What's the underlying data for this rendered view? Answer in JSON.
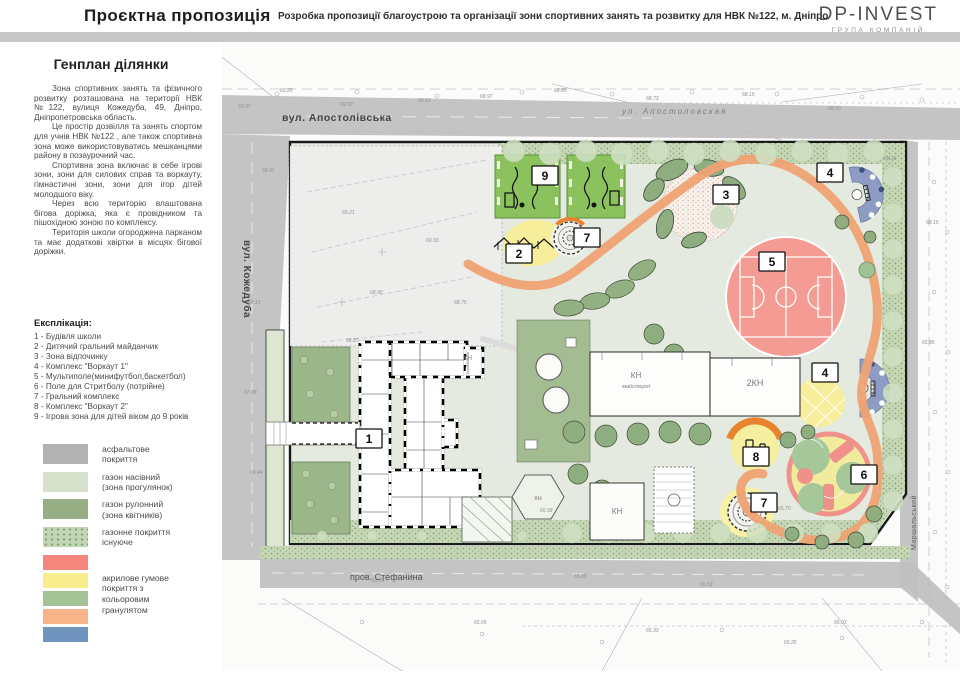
{
  "header": {
    "title": "Проєктна пропозиція",
    "subtitle": "Розробка пропозиції благоустрою та організації зони спортивних занять та розвитку для НВК №122, м. Дніпро",
    "logo": {
      "name": "DP-INVEST",
      "tagline": "ГРУПА КОМПАНІЙ"
    }
  },
  "sidebar": {
    "heading": "Генплан ділянки",
    "paragraphs": [
      "Зона спортивних занять та фізичного розвитку розташована на території НВК №122, вулиця Кожедуба, 49, Дніпро, Дніпропетровська область.",
      "Це простір дозвілля та занять спортом для учнів НВК №122 , але також спортивна зона може використовуватись мешканцями району в позаурочний час.",
      "Спортивна зона включає в себе ігрові зони, зони для силових справ та воркауту, гімнастичні зони, зони для ігор дітей молодшого віку.",
      "Через всю територію влаштована бігова доріжка, яка є провідником та пішохідною зоною по комплексу.",
      "Територія школи огороджена парканом та має додаткові хвіртки в місцях бігової доріжки."
    ],
    "explication_heading": "Експлікація:",
    "explication": [
      "1 - Будівля школи",
      "2 - Дитячий гральний майданчик",
      "3 - Зона відпочинку",
      "4 - Комплекс \"Воркаут 1\"",
      "5 - Мультиполе(минифутбол,баскетбол)",
      "6 - Поле для Стритболу (потрійне)",
      "7 - Гральний комплекс",
      "8 - Комплекс \"Воркаут 2\"",
      "9 - Ігрова зона для дітей віком до 9 років"
    ]
  },
  "surface_legend": {
    "simple": [
      {
        "color": "#b2b2b2",
        "type": "solid",
        "label": "асфальтове\nпокриття"
      },
      {
        "color": "#d6e0cb",
        "type": "solid",
        "label": "газон насівний\n(зона прогулянок)"
      },
      {
        "color": "#97ad83",
        "type": "solid",
        "label": "газон рулонний\n(зона квітників)"
      },
      {
        "color": "#c3d6b3",
        "type": "dotted",
        "label": "газонне покриття\nіснуюче"
      }
    ],
    "granulate": {
      "colors": [
        "#f5877f",
        "#f9ee8e",
        "#a3c296",
        "#f6b488",
        "#6f94bd"
      ],
      "label": "акрилове гумове\nпокриття з\nкольоровим\nгранулятом"
    }
  },
  "map": {
    "street_labels": {
      "apostolivska": "вул. Апостолівська",
      "apostolovskaya_survey": "ул. Апостоловская",
      "kozheduba": "вул. Кожедуба",
      "stefanyna": "пров. Стефанина",
      "marshalskyi": "Маршальський"
    },
    "building_labels": [
      {
        "x": 246,
        "y": 318,
        "t": "КН",
        "s": 6
      },
      {
        "x": 414,
        "y": 336,
        "t": "КН",
        "s": 8
      },
      {
        "x": 414,
        "y": 346,
        "t": "майстерні",
        "s": 5.5
      },
      {
        "x": 533,
        "y": 344,
        "t": "2КН",
        "s": 9
      },
      {
        "x": 395,
        "y": 472,
        "t": "КН",
        "s": 8
      },
      {
        "x": 316,
        "y": 458,
        "t": "КН",
        "s": 5.5
      }
    ],
    "markers": [
      {
        "n": "1",
        "x": 147,
        "y": 397
      },
      {
        "n": "2",
        "x": 297,
        "y": 212
      },
      {
        "n": "3",
        "x": 504,
        "y": 153
      },
      {
        "n": "4",
        "x": 608,
        "y": 131
      },
      {
        "n": "4",
        "x": 603,
        "y": 331
      },
      {
        "n": "5",
        "x": 550,
        "y": 220
      },
      {
        "n": "6",
        "x": 642,
        "y": 433
      },
      {
        "n": "7",
        "x": 365,
        "y": 196
      },
      {
        "n": "7",
        "x": 542,
        "y": 461
      },
      {
        "n": "8",
        "x": 534,
        "y": 415
      },
      {
        "n": "9",
        "x": 323,
        "y": 134
      }
    ],
    "survey_marks": [
      {
        "x": 58,
        "y": 50,
        "v": "69.25"
      },
      {
        "x": 16,
        "y": 66,
        "v": "69.07"
      },
      {
        "x": 118,
        "y": 64,
        "v": "69.50"
      },
      {
        "x": 196,
        "y": 60,
        "v": "69.53"
      },
      {
        "x": 258,
        "y": 56,
        "v": "68.97"
      },
      {
        "x": 332,
        "y": 50,
        "v": "68.85"
      },
      {
        "x": 424,
        "y": 58,
        "v": "68.73"
      },
      {
        "x": 520,
        "y": 54,
        "v": "68.15"
      },
      {
        "x": 606,
        "y": 68,
        "v": "68.20"
      },
      {
        "x": 40,
        "y": 130,
        "v": "68.91"
      },
      {
        "x": 26,
        "y": 262,
        "v": "68.15"
      },
      {
        "x": 22,
        "y": 352,
        "v": "67.88"
      },
      {
        "x": 28,
        "y": 432,
        "v": "66.44"
      },
      {
        "x": 120,
        "y": 172,
        "v": "69.21"
      },
      {
        "x": 204,
        "y": 200,
        "v": "69.33"
      },
      {
        "x": 148,
        "y": 252,
        "v": "68.90"
      },
      {
        "x": 232,
        "y": 262,
        "v": "68.75"
      },
      {
        "x": 124,
        "y": 300,
        "v": "68.87"
      },
      {
        "x": 150,
        "y": 540,
        "v": "65.64"
      },
      {
        "x": 352,
        "y": 536,
        "v": "65.85"
      },
      {
        "x": 478,
        "y": 544,
        "v": "65.53"
      },
      {
        "x": 252,
        "y": 582,
        "v": "65.65"
      },
      {
        "x": 424,
        "y": 590,
        "v": "65.33"
      },
      {
        "x": 612,
        "y": 582,
        "v": "65.03"
      },
      {
        "x": 562,
        "y": 602,
        "v": "65.25"
      },
      {
        "x": 700,
        "y": 302,
        "v": "65.85"
      },
      {
        "x": 704,
        "y": 182,
        "v": "68.15"
      },
      {
        "x": 662,
        "y": 118,
        "v": "68.26"
      },
      {
        "x": 318,
        "y": 470,
        "v": "66.58"
      },
      {
        "x": 556,
        "y": 468,
        "v": "65.70"
      }
    ]
  }
}
